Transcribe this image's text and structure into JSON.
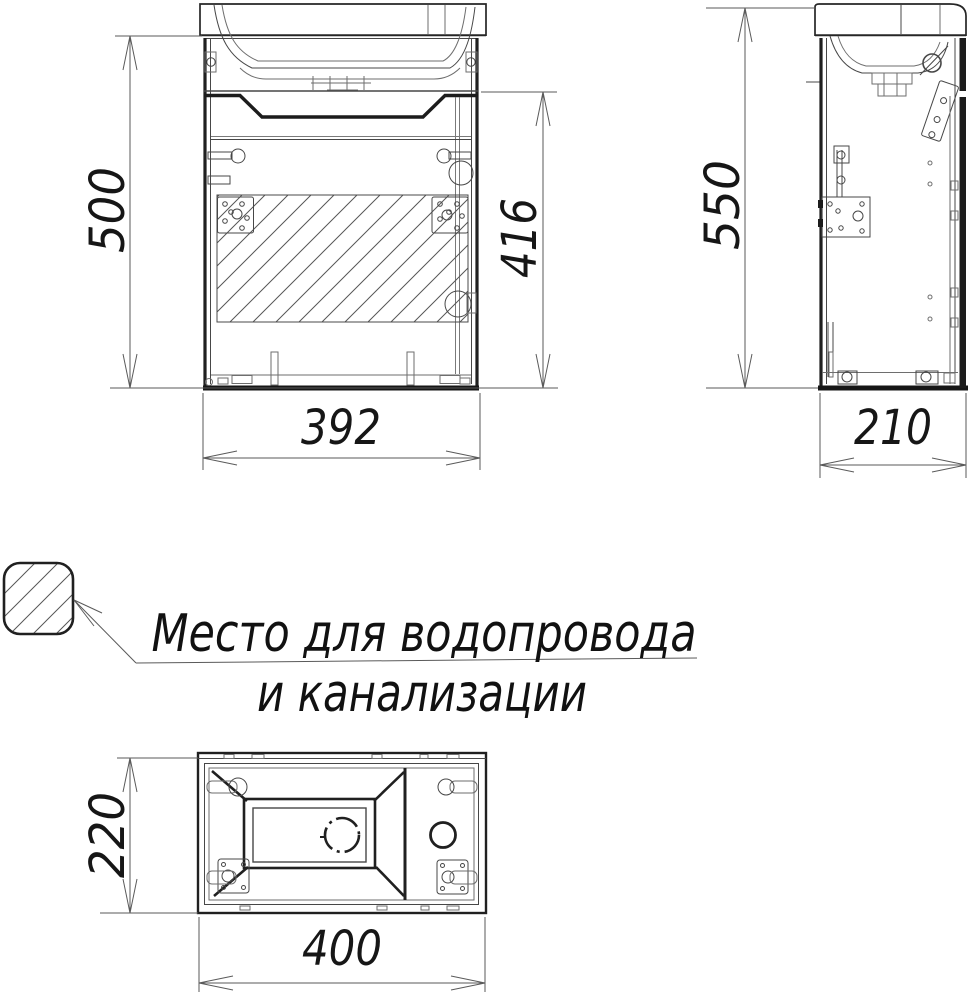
{
  "drawing": {
    "dimensions": {
      "front_height": "500",
      "front_inner_height": "416",
      "front_width": "392",
      "side_height": "550",
      "side_depth": "210",
      "top_depth": "220",
      "top_width": "400"
    },
    "legend": {
      "line1": "Место для водопровода",
      "line2": "и канализации"
    },
    "colors": {
      "line_bold": "#202020",
      "line_thin": "#4a4a4a",
      "background": "#ffffff"
    }
  }
}
